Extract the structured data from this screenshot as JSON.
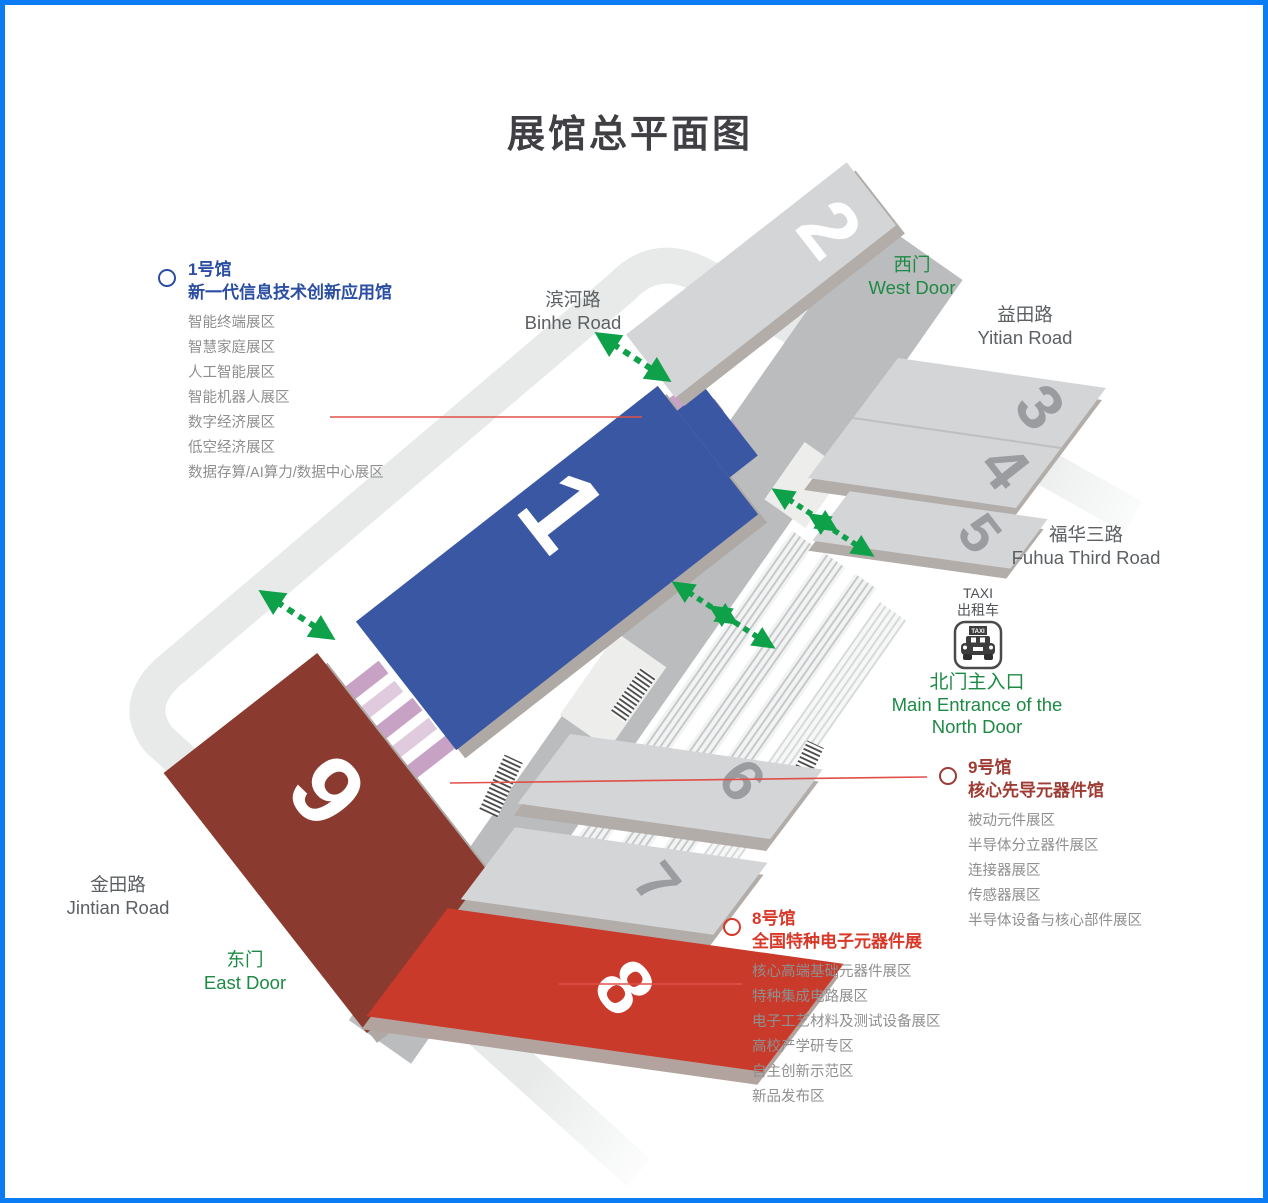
{
  "title": "展馆总平面图",
  "roads": {
    "binhe": {
      "zh": "滨河路",
      "en": "Binhe Road"
    },
    "yitian": {
      "zh": "益田路",
      "en": "Yitian Road"
    },
    "fuhua": {
      "zh": "福华三路",
      "en": "Fuhua Third Road"
    },
    "jintian": {
      "zh": "金田路",
      "en": "Jintian Road"
    }
  },
  "doors": {
    "west": {
      "zh": "西门",
      "en": "West Door"
    },
    "east": {
      "zh": "东门",
      "en": "East Door"
    }
  },
  "north_entrance": {
    "zh": "北门主入口",
    "en1": "Main Entrance of the",
    "en2": "North Door"
  },
  "taxi": {
    "en": "TAXI",
    "zh": "出租车",
    "icon_sign": "TAXI"
  },
  "halls": {
    "h1": "1",
    "h2": "2",
    "h3": "3",
    "h4": "4",
    "h5": "5",
    "h6": "6",
    "h7": "7",
    "h8": "8",
    "h9": "9"
  },
  "legends": {
    "hall1": {
      "no": "1号馆",
      "name": "新一代信息技术创新应用馆",
      "items": [
        "智能终端展区",
        "智慧家庭展区",
        "人工智能展区",
        "智能机器人展区",
        "数字经济展区",
        "低空经济展区",
        "数据存算/AI算力/数据中心展区"
      ]
    },
    "hall9": {
      "no": "9号馆",
      "name": "核心先导元器件馆",
      "items": [
        "被动元件展区",
        "半导体分立器件展区",
        "连接器展区",
        "传感器展区",
        "半导体设备与核心部件展区"
      ]
    },
    "hall8": {
      "no": "8号馆",
      "name": "全国特种电子元器件展",
      "items": [
        "核心高端基础元器件展区",
        "特种集成电路展区",
        "电子工艺材料及测试设备展区",
        "高校产学研专区",
        "自主创新示范区",
        "新品发布区"
      ]
    }
  },
  "colors": {
    "frame_border": "#0b7cf4",
    "hall1_blue": "#3a57a3",
    "hall9_maroon": "#8b3a2f",
    "hall8_red": "#c93a2b",
    "hall_gray": "#d3d5d7",
    "spine_gray": "#babcbe",
    "road_gray": "#e8eaea",
    "crosswalk_pink": "#c7a2c5",
    "arrow_green": "#0fa04a",
    "callout_red": "#e05048"
  }
}
